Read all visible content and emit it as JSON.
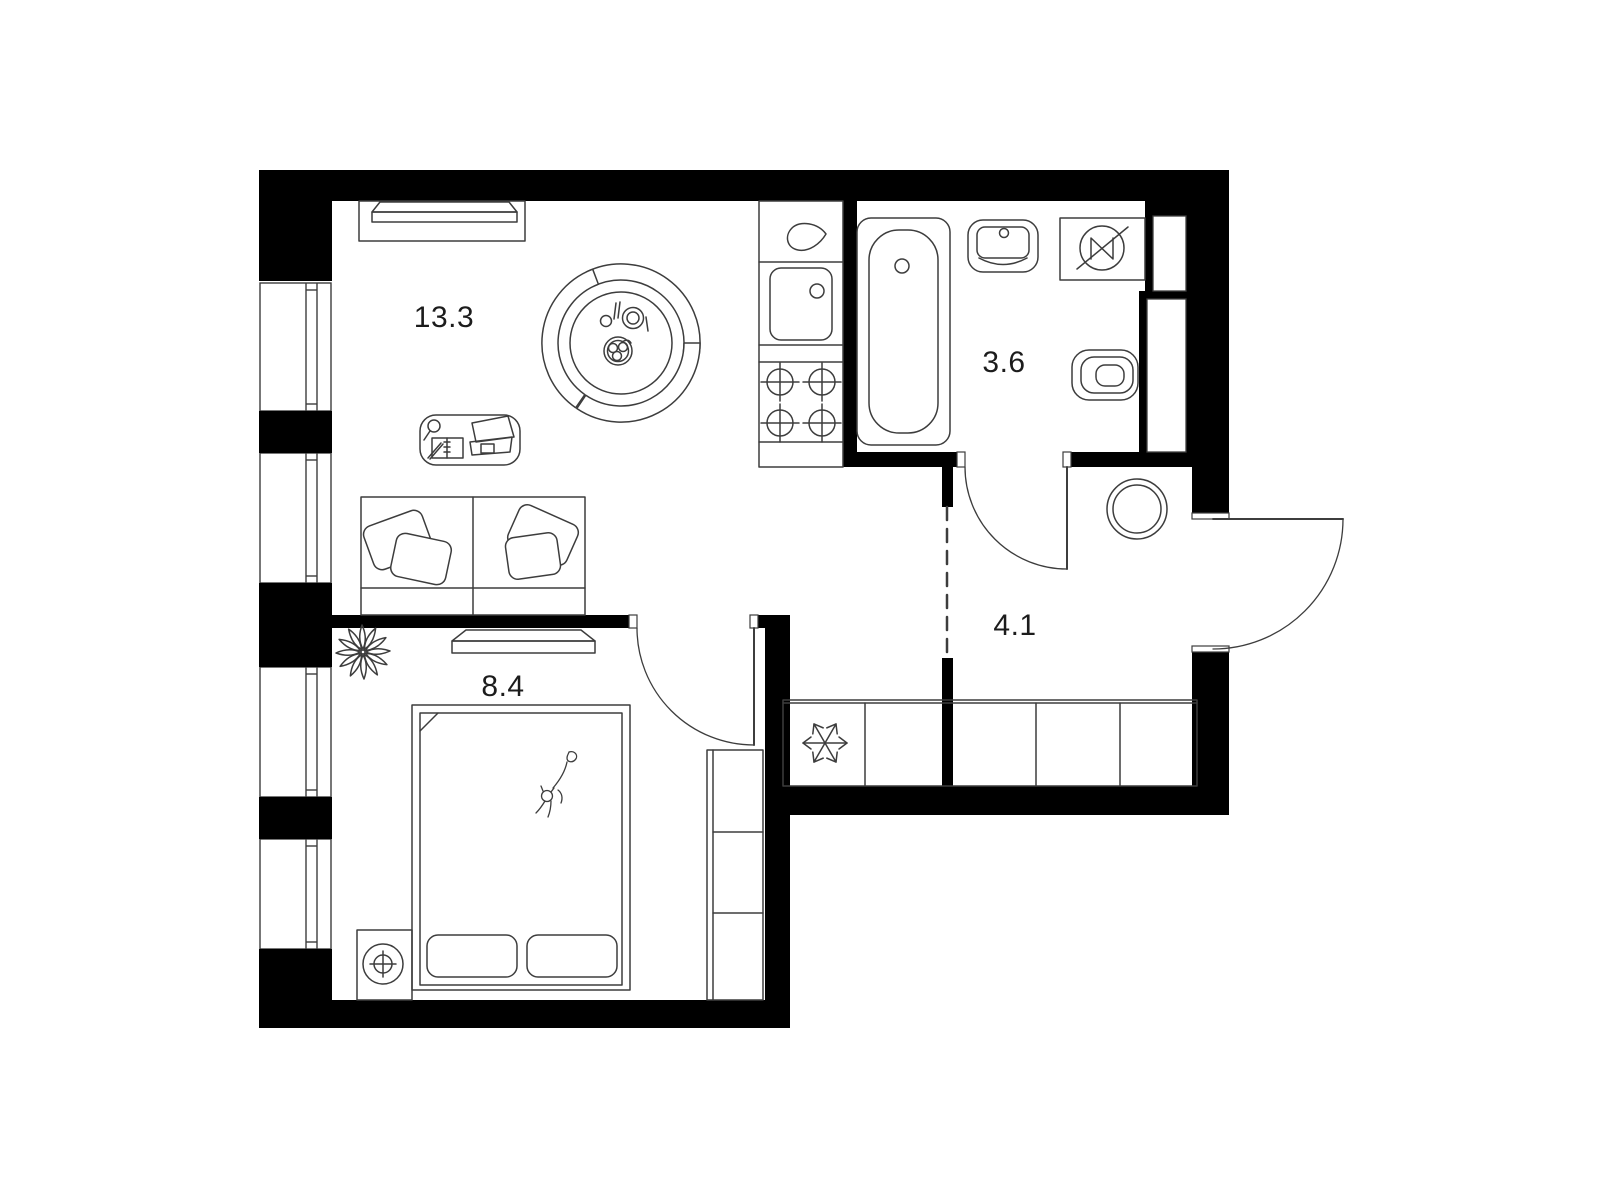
{
  "floorplan": {
    "type": "apartment-floor-plan",
    "rooms": [
      {
        "name": "living-room-kitchen",
        "area_label": "13.3"
      },
      {
        "name": "bathroom",
        "area_label": "3.6"
      },
      {
        "name": "hallway",
        "area_label": "4.1"
      },
      {
        "name": "bedroom",
        "area_label": "8.4"
      }
    ],
    "colors": {
      "wall": "#000000",
      "line": "#3d3d3d",
      "background": "#ffffff",
      "label": "#1c1c1c"
    },
    "icons": [
      "window-icon",
      "door-swing-icon",
      "tv-icon",
      "tv-cabinet-icon",
      "dining-table-icon",
      "chair-icon",
      "plate-icon",
      "fruit-bowl-icon",
      "desk-icon",
      "laptop-icon",
      "magnifier-icon",
      "notebook-icon",
      "sofa-icon",
      "pillow-icon",
      "kitchen-faucet-icon",
      "kitchen-sink-icon",
      "stove-icon",
      "bathtub-icon",
      "washbasin-icon",
      "electrical-panel-icon",
      "toilet-icon",
      "washing-machine-icon",
      "snowflake-fridge-icon",
      "cabinet-row-icon",
      "wardrobe-icon",
      "plant-icon",
      "bed-icon",
      "cat-icon",
      "nightstand-lamp-icon",
      "shaft-icon"
    ]
  }
}
